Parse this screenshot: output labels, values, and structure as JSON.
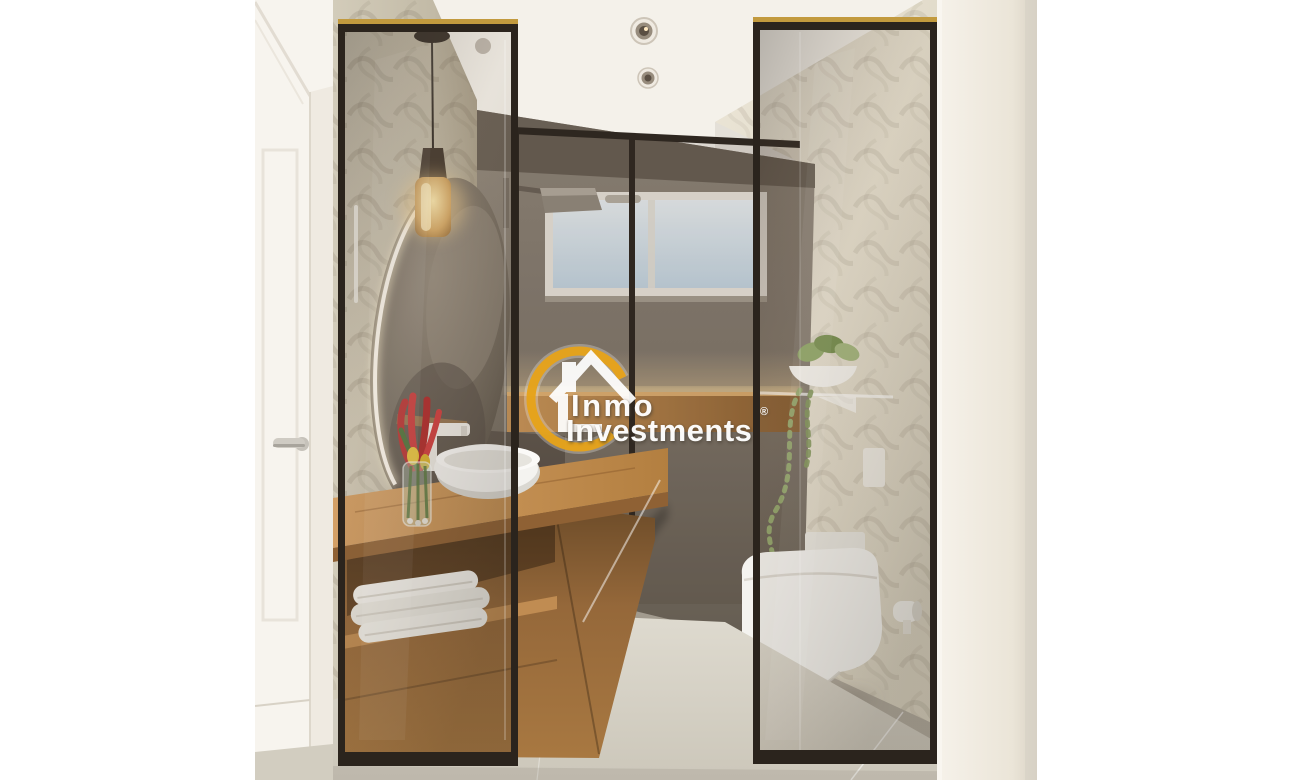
{
  "scene": {
    "type": "3d-interior-render",
    "room": "modern bathroom with black-framed glass partitions, oak floating vanity with white vessel sink, backlit oval mirror, pendant lamp, walk-in shower with window, wall-hung toilet and trailing plant"
  },
  "watermark": {
    "brand_line1": "Inmo",
    "brand_line2": "Investments",
    "registered_mark": "®",
    "icon": "house-in-ring-icon",
    "ring_color": "#E7A41C",
    "text_color": "#FFFFFF"
  },
  "palette": {
    "page_background": "#FFFFFF",
    "ceiling": "#F4F1EA",
    "vanity_wall": "#C9C1AF",
    "shower_wall": "#837A6E",
    "toilet_wall": "#E5DFCF",
    "wood": "#BE8A50",
    "floor_tile": "#D7D3C8",
    "glass_frame": "#2B241D",
    "sky": "#D9E5EC",
    "led_glow": "#FFE2A4"
  }
}
